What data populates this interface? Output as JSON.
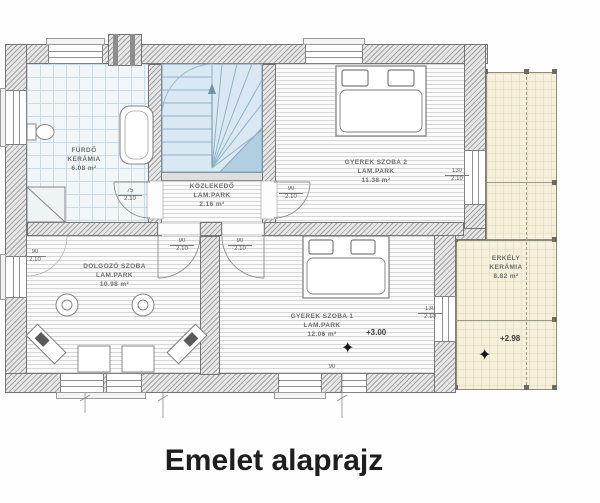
{
  "meta": {
    "caption": "Emelet alaprajz"
  },
  "colors": {
    "wall_gray": "#8a8a8a",
    "stair_blue": "#d9e8f2",
    "tile_blue": "#f1f6f9",
    "balcony_beige": "#f5efdc",
    "label_gray": "#6f6f6f"
  },
  "icons": {
    "level_marker": "✦"
  },
  "rooms": {
    "furdo": {
      "name": "FÜRDŐ",
      "finish": "KERÁMIA",
      "area": "6.08 m²"
    },
    "kozlekedo": {
      "name": "KÖZLEKEDŐ",
      "finish": "LAM.PARK",
      "area": "2.16 m²"
    },
    "gyerek2": {
      "name": "GYEREK SZOBA 2",
      "finish": "LAM.PARK",
      "area": "11.38 m²"
    },
    "dolgozo": {
      "name": "DOLGOZÓ SZOBA",
      "finish": "LAM.PARK",
      "area": "10.98 m²"
    },
    "gyerek1": {
      "name": "GYEREK SZOBA 1",
      "finish": "LAM.PARK",
      "area": "12.06 m²"
    },
    "erkely": {
      "name": "ERKÉLY",
      "finish": "KERÁMIA",
      "area": "8.82 m²"
    }
  },
  "levels": {
    "gyerek1": "+3.00",
    "erkely": "+2.98"
  },
  "dims": {
    "furdo_door_w": "75",
    "furdo_door_h": "2.10",
    "gyerek2_door_w": "90",
    "gyerek2_door_h": "2.10",
    "dolgozo_door_w": "90",
    "dolgozo_door_h": "2.10",
    "gyerek1_door_w": "90",
    "gyerek1_door_h": "2.10",
    "dolgozo_window_w": "90",
    "dolgozo_window_h": "2.10",
    "gyerek2_window_w": "130",
    "gyerek2_window_h": "2.10",
    "gyerek1_window_w": "130",
    "gyerek1_window_h": "2.10",
    "terrace_door_w": "90"
  }
}
